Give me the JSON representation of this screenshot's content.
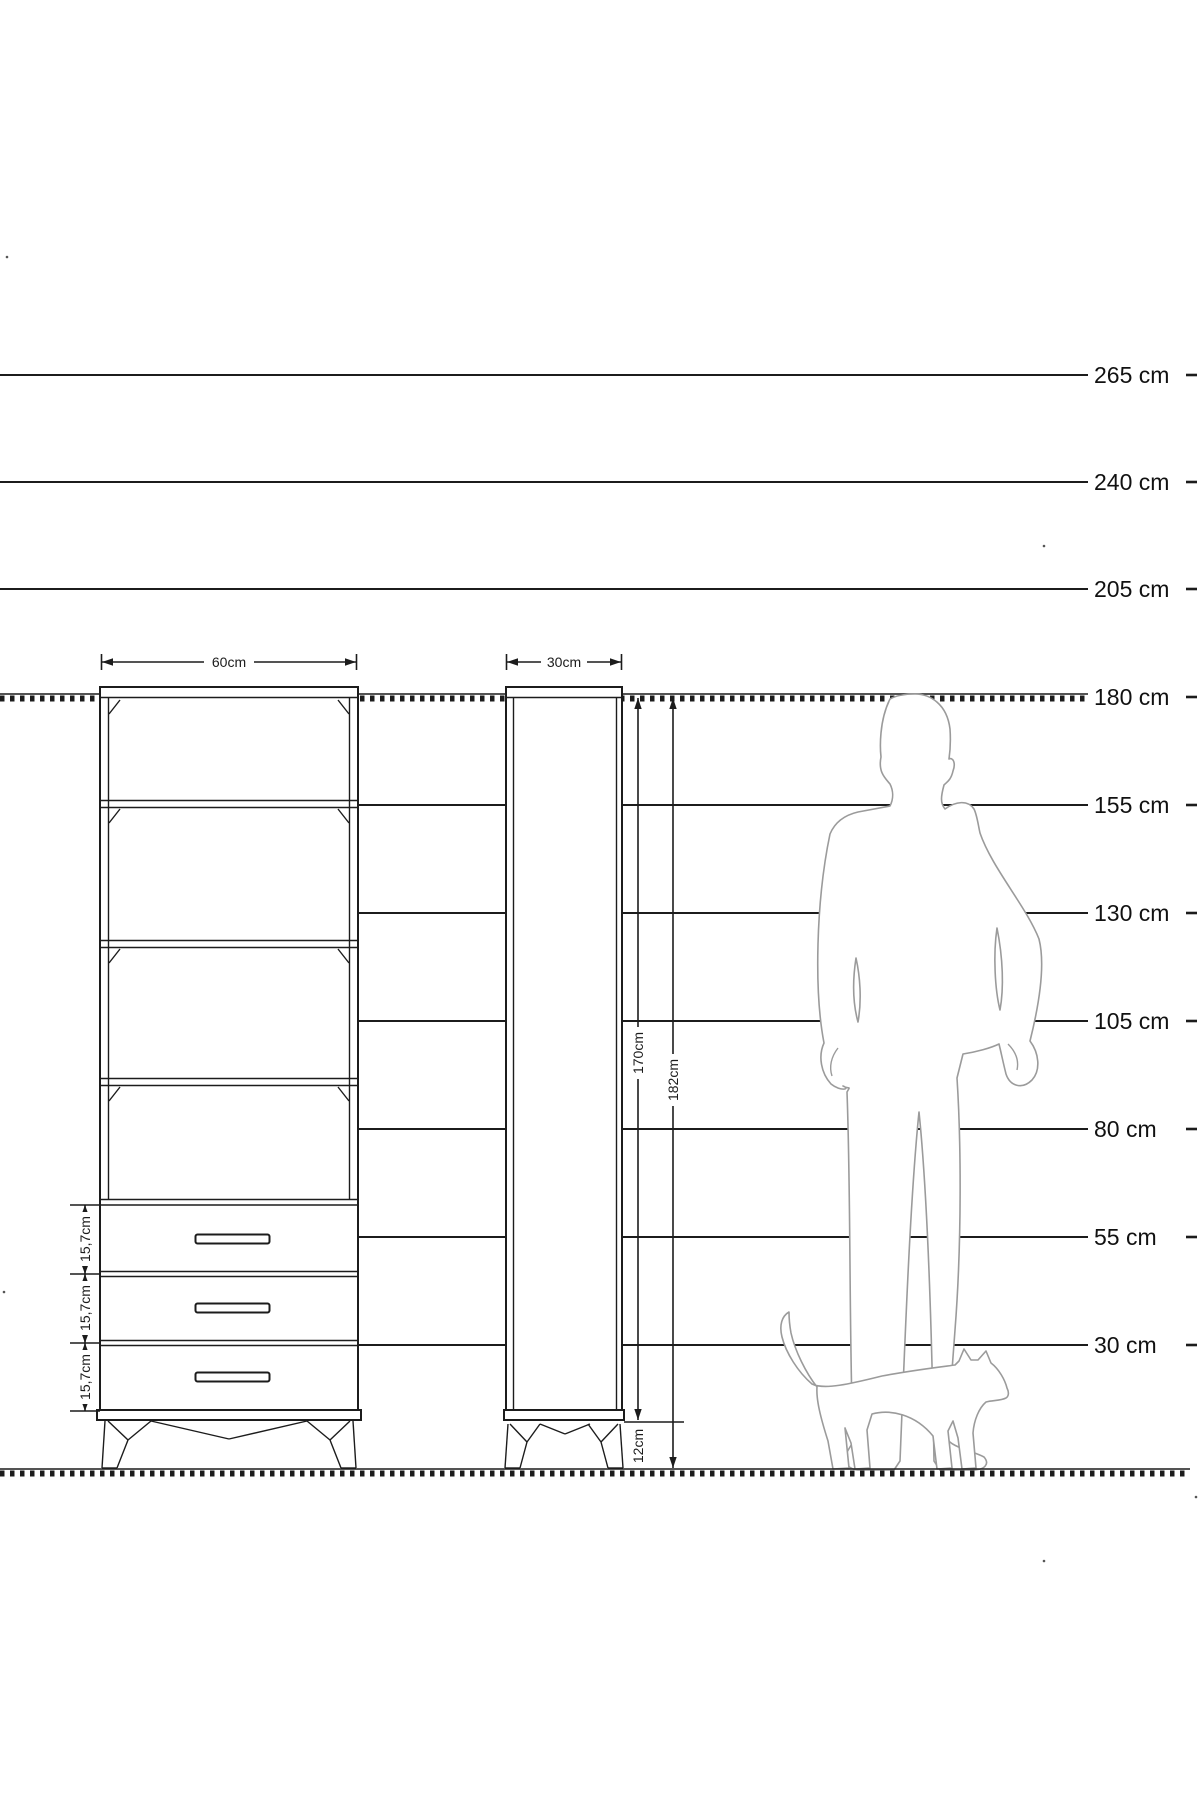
{
  "diagram": {
    "scale_labels": [
      "265 cm",
      "240 cm",
      "205 cm",
      "180 cm",
      "155 cm",
      "130 cm",
      "105 cm",
      "80 cm",
      "55 cm",
      "30 cm"
    ],
    "front_view": {
      "width_label": "60cm",
      "drawer_height_labels": [
        "15,7cm",
        "15,7cm",
        "15,7cm"
      ],
      "drawer_count": 3,
      "open_shelf_count": 4
    },
    "side_view": {
      "depth_label": "30cm",
      "body_height_label": "170cm",
      "total_height_label": "182cm",
      "leg_height_label": "12cm"
    },
    "colors": {
      "line": "#1c1c1c",
      "silhouette_outline": "#9b9b9b",
      "background": "#ffffff"
    }
  }
}
